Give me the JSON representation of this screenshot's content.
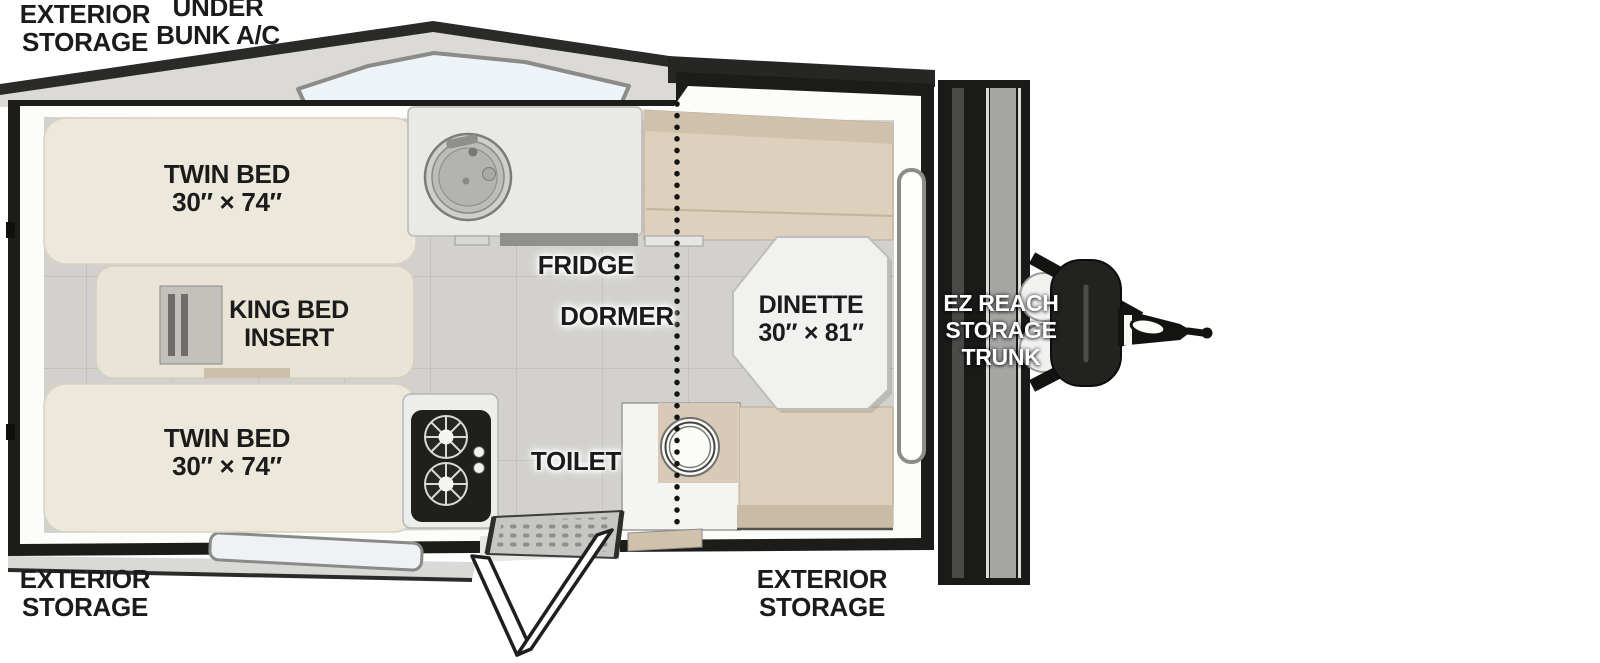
{
  "page": {
    "background": "#ffffff"
  },
  "labels": {
    "exterior_storage_rear_top": {
      "line1": "EXTERIOR",
      "line2": "STORAGE"
    },
    "under_bunk_ac": {
      "line1": "UNDER",
      "line2": "BUNK A/C"
    },
    "twin_bed_top": {
      "line1": "TWIN BED",
      "line2": "30″ × 74″"
    },
    "king_bed_insert": {
      "line1": "KING BED",
      "line2": "INSERT"
    },
    "twin_bed_bottom": {
      "line1": "TWIN BED",
      "line2": "30″ × 74″"
    },
    "fridge": {
      "line1": "FRIDGE"
    },
    "dormer": {
      "line1": "DORMER"
    },
    "toilet": {
      "line1": "TOILET"
    },
    "dinette": {
      "line1": "DINETTE",
      "line2": "30″ × 81″"
    },
    "ez_reach_storage_trunk": {
      "line1": "EZ REACH",
      "line2": "STORAGE",
      "line3": "TRUNK"
    },
    "exterior_storage_rear_bottom": {
      "line1": "EXTERIOR",
      "line2": "STORAGE"
    },
    "exterior_storage_door_side": {
      "line1": "EXTERIOR",
      "line2": "STORAGE"
    }
  },
  "colors": {
    "outline_black": "#1c1c1a",
    "wall_white": "#fcfcfb",
    "floor_gray": "#d2d1cd",
    "roof_gray": "#dcdad6",
    "roof_edge_dark": "#2a2a28",
    "skylight_blue": "#eef3f7",
    "bed_cream": "#ece8db",
    "king_bed_cream": "#e9e4d6",
    "bench_tan": "#ddd0bc",
    "bench_back_tan": "#cfc1ac",
    "bench_step_tan": "#c9bba6",
    "table_white": "#f1f1f0",
    "counter_white": "#e9e9e8",
    "stove_black": "#1f1f1d",
    "trunk_black": "#1a1a18",
    "window_pane": "#eef2f5",
    "label_black": "#1b1b1b",
    "label_white": "#ffffff"
  }
}
